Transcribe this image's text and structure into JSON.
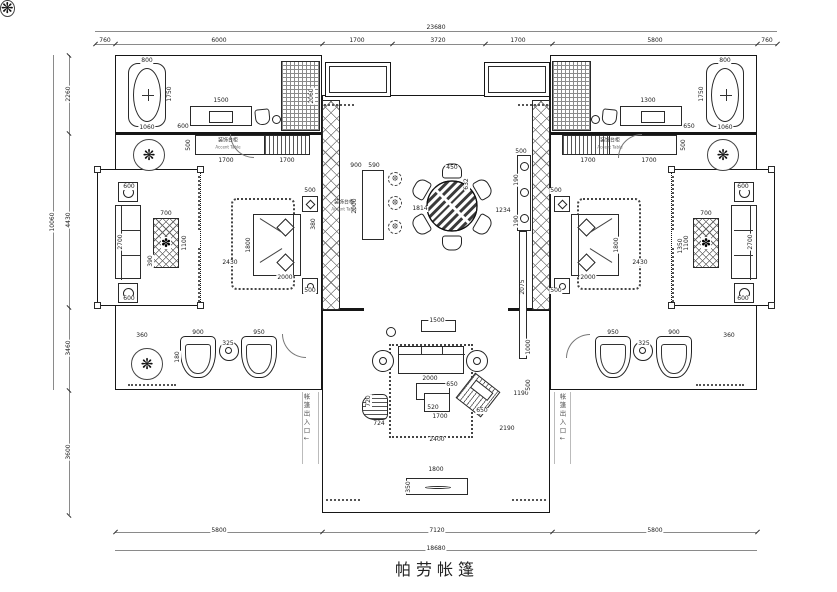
{
  "title": "帕劳帐篷",
  "dimensions": {
    "top_total": "23680",
    "top_segments": [
      "760",
      "6000",
      "1700",
      "3720",
      "1700",
      "5800",
      "760"
    ],
    "left_total": "10060",
    "left_segments": [
      "2260",
      "4430",
      "3460",
      "3600"
    ],
    "bottom_segments": [
      "5800",
      "7120",
      "5800"
    ],
    "bottom_total": "18680"
  },
  "cabinet_labels": [
    {
      "cn": "装饰台柜",
      "en": "Accent Table",
      "x": 228,
      "y": 144
    },
    {
      "cn": "装饰台柜",
      "en": "Accent Table",
      "x": 610,
      "y": 144
    },
    {
      "cn": "装饰台柜",
      "en": "Accent Table",
      "x": 344,
      "y": 206
    }
  ],
  "path_labels": [
    {
      "t": "帐篷出入口↓",
      "x": 306,
      "y": 418
    },
    {
      "t": "帐篷出入口↓",
      "x": 562,
      "y": 418
    }
  ],
  "annotations": [
    {
      "t": "23680",
      "x": 436,
      "y": 28
    },
    {
      "t": "760",
      "x": 105,
      "y": 41
    },
    {
      "t": "6000",
      "x": 219,
      "y": 41
    },
    {
      "t": "1700",
      "x": 357,
      "y": 41
    },
    {
      "t": "3720",
      "x": 438,
      "y": 41
    },
    {
      "t": "1700",
      "x": 518,
      "y": 41
    },
    {
      "t": "5800",
      "x": 655,
      "y": 41
    },
    {
      "t": "760",
      "x": 767,
      "y": 41
    },
    {
      "t": "10060",
      "x": 53,
      "y": 222,
      "v": 1
    },
    {
      "t": "2260",
      "x": 69,
      "y": 94,
      "v": 1
    },
    {
      "t": "4430",
      "x": 69,
      "y": 220,
      "v": 1
    },
    {
      "t": "3460",
      "x": 69,
      "y": 348,
      "v": 1
    },
    {
      "t": "3600",
      "x": 69,
      "y": 452,
      "v": 1
    },
    {
      "t": "5800",
      "x": 219,
      "y": 531
    },
    {
      "t": "7120",
      "x": 437,
      "y": 531
    },
    {
      "t": "5800",
      "x": 655,
      "y": 531
    },
    {
      "t": "18680",
      "x": 436,
      "y": 549
    },
    {
      "t": "800",
      "x": 147,
      "y": 61
    },
    {
      "t": "1750",
      "x": 170,
      "y": 94,
      "v": 1
    },
    {
      "t": "1060",
      "x": 147,
      "y": 128
    },
    {
      "t": "1500",
      "x": 221,
      "y": 101
    },
    {
      "t": "600",
      "x": 183,
      "y": 127
    },
    {
      "t": "2060",
      "x": 312,
      "y": 96,
      "v": 1
    },
    {
      "t": "500",
      "x": 189,
      "y": 145,
      "v": 1
    },
    {
      "t": "1700",
      "x": 226,
      "y": 161
    },
    {
      "t": "1700",
      "x": 287,
      "y": 161
    },
    {
      "t": "2430",
      "x": 230,
      "y": 263
    },
    {
      "t": "1800",
      "x": 249,
      "y": 245,
      "v": 1
    },
    {
      "t": "2000",
      "x": 285,
      "y": 278
    },
    {
      "t": "500",
      "x": 310,
      "y": 191
    },
    {
      "t": "380",
      "x": 314,
      "y": 224,
      "v": 1
    },
    {
      "t": "500",
      "x": 310,
      "y": 291
    },
    {
      "t": "700",
      "x": 166,
      "y": 214
    },
    {
      "t": "1100",
      "x": 185,
      "y": 243,
      "v": 1
    },
    {
      "t": "390",
      "x": 151,
      "y": 261,
      "v": 1
    },
    {
      "t": "2700",
      "x": 121,
      "y": 242,
      "v": 1
    },
    {
      "t": "600",
      "x": 129,
      "y": 187
    },
    {
      "t": "600",
      "x": 129,
      "y": 299
    },
    {
      "t": "360",
      "x": 142,
      "y": 336
    },
    {
      "t": "900",
      "x": 198,
      "y": 333
    },
    {
      "t": "950",
      "x": 259,
      "y": 333
    },
    {
      "t": "325",
      "x": 228,
      "y": 344
    },
    {
      "t": "180",
      "x": 178,
      "y": 357,
      "v": 1
    },
    {
      "t": "900",
      "x": 356,
      "y": 166
    },
    {
      "t": "590",
      "x": 374,
      "y": 166
    },
    {
      "t": "2000",
      "x": 355,
      "y": 206,
      "v": 1
    },
    {
      "t": "1814",
      "x": 420,
      "y": 209
    },
    {
      "t": "450",
      "x": 452,
      "y": 168
    },
    {
      "t": "632",
      "x": 467,
      "y": 184,
      "v": 1
    },
    {
      "t": "1234",
      "x": 503,
      "y": 211
    },
    {
      "t": "190",
      "x": 517,
      "y": 180,
      "v": 1
    },
    {
      "t": "190",
      "x": 517,
      "y": 221,
      "v": 1
    },
    {
      "t": "500",
      "x": 521,
      "y": 152
    },
    {
      "t": "2075",
      "x": 523,
      "y": 287,
      "v": 1
    },
    {
      "t": "1350",
      "x": 681,
      "y": 246,
      "v": 1
    },
    {
      "t": "1800",
      "x": 617,
      "y": 245,
      "v": 1
    },
    {
      "t": "2000",
      "x": 588,
      "y": 278
    },
    {
      "t": "500",
      "x": 556,
      "y": 191
    },
    {
      "t": "500",
      "x": 556,
      "y": 291
    },
    {
      "t": "2430",
      "x": 640,
      "y": 263
    },
    {
      "t": "1700",
      "x": 588,
      "y": 161
    },
    {
      "t": "1700",
      "x": 649,
      "y": 161
    },
    {
      "t": "500",
      "x": 684,
      "y": 145,
      "v": 1
    },
    {
      "t": "800",
      "x": 725,
      "y": 61
    },
    {
      "t": "1750",
      "x": 702,
      "y": 94,
      "v": 1
    },
    {
      "t": "1060",
      "x": 725,
      "y": 128
    },
    {
      "t": "1300",
      "x": 648,
      "y": 101
    },
    {
      "t": "650",
      "x": 689,
      "y": 127
    },
    {
      "t": "700",
      "x": 706,
      "y": 214
    },
    {
      "t": "1100",
      "x": 687,
      "y": 243,
      "v": 1
    },
    {
      "t": "2700",
      "x": 751,
      "y": 242,
      "v": 1
    },
    {
      "t": "600",
      "x": 743,
      "y": 187
    },
    {
      "t": "600",
      "x": 743,
      "y": 299
    },
    {
      "t": "360",
      "x": 729,
      "y": 336
    },
    {
      "t": "900",
      "x": 674,
      "y": 333
    },
    {
      "t": "950",
      "x": 613,
      "y": 333
    },
    {
      "t": "325",
      "x": 644,
      "y": 344
    },
    {
      "t": "1500",
      "x": 437,
      "y": 321
    },
    {
      "t": "2000",
      "x": 430,
      "y": 379
    },
    {
      "t": "650",
      "x": 452,
      "y": 385
    },
    {
      "t": "520",
      "x": 433,
      "y": 408
    },
    {
      "t": "1700",
      "x": 440,
      "y": 417
    },
    {
      "t": "2400",
      "x": 437,
      "y": 440
    },
    {
      "t": "720",
      "x": 369,
      "y": 401,
      "v": 1
    },
    {
      "t": "724",
      "x": 379,
      "y": 424
    },
    {
      "t": "650",
      "x": 482,
      "y": 411
    },
    {
      "t": "1190",
      "x": 521,
      "y": 394
    },
    {
      "t": "2190",
      "x": 507,
      "y": 429
    },
    {
      "t": "1000",
      "x": 529,
      "y": 347,
      "v": 1
    },
    {
      "t": "500",
      "x": 529,
      "y": 385,
      "v": 1
    },
    {
      "t": "1800",
      "x": 436,
      "y": 470
    },
    {
      "t": "350",
      "x": 409,
      "y": 487,
      "v": 1
    }
  ]
}
